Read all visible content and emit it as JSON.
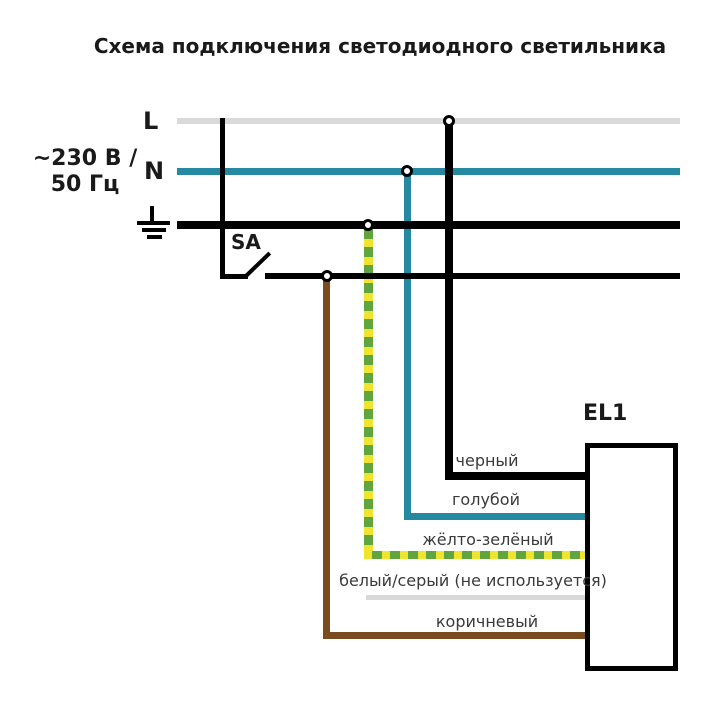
{
  "title": "Схема подключения светодиодного светильника",
  "source": {
    "voltage_line1": "~230 В /",
    "voltage_line2": "50 Гц",
    "l_label": "L",
    "n_label": "N"
  },
  "switch": {
    "label": "SA"
  },
  "luminaire": {
    "label": "EL1"
  },
  "wires": {
    "black_label": "черный",
    "blue_label": "голубой",
    "yellow_green_label": "жёлто-зелёный",
    "white_gray_label": "белый/серый (не используется)",
    "brown_label": "коричневый"
  },
  "colors": {
    "l_line_gray": "#d9d9d9",
    "n_line_teal": "#2589a1",
    "pe_line_black": "#000000",
    "wire_yellow": "#f0e52e",
    "wire_green": "#61a53f",
    "wire_brown": "#7b4b20",
    "wire_unused_gray": "#d9d9d9",
    "title_text": "#1a1a1a",
    "wire_label_text": "#3a3a3a"
  }
}
